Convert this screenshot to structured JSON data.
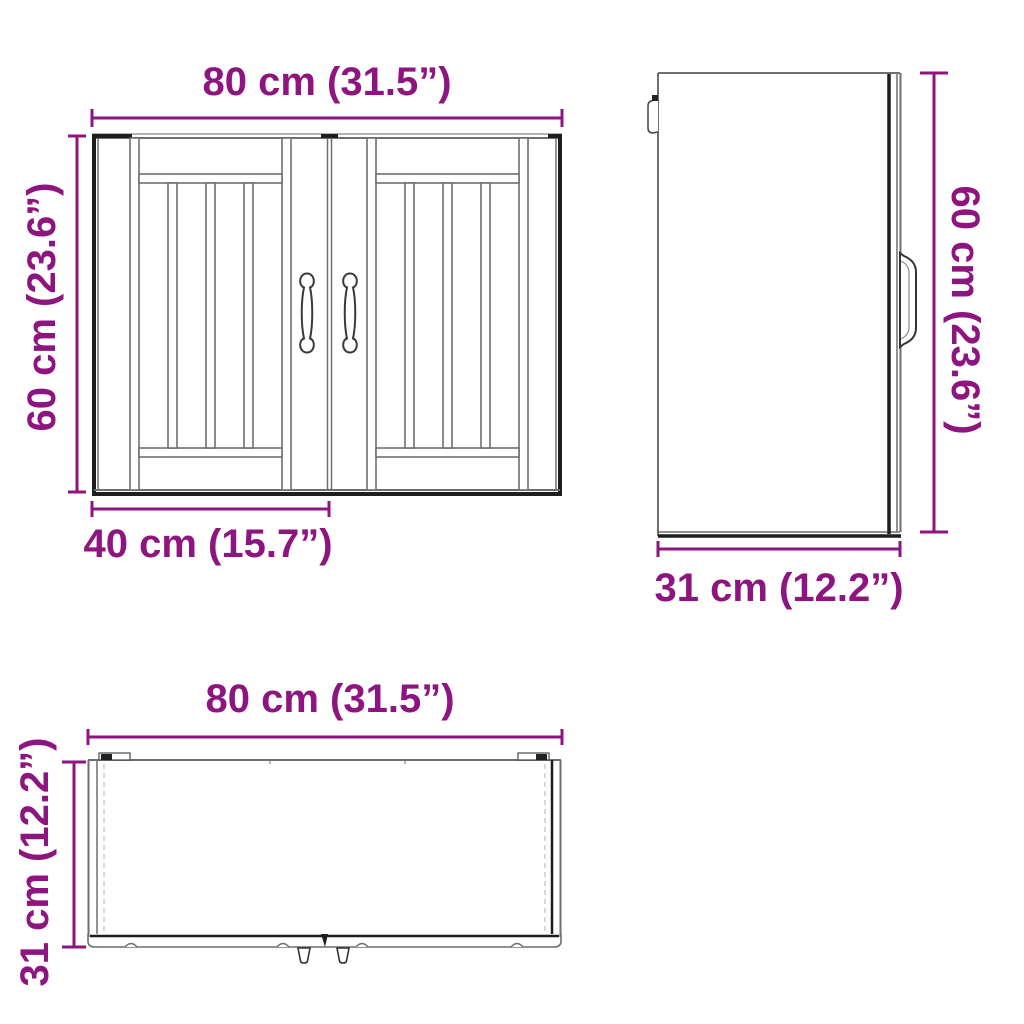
{
  "colors": {
    "dimension": "#8E147F",
    "outline_dark": "#1e1e1e",
    "outline_gray": "#6f6f6f"
  },
  "views": {
    "front": {
      "dims": {
        "width": "80 cm (31.5”)",
        "height": "60 cm (23.6”)",
        "door_width": "40 cm (15.7”)"
      }
    },
    "side": {
      "dims": {
        "height": "60 cm (23.6”)",
        "depth": "31 cm (12.2”)"
      }
    },
    "bottom": {
      "dims": {
        "width": "80 cm (31.5”)",
        "depth": "31 cm (12.2”)"
      }
    }
  }
}
